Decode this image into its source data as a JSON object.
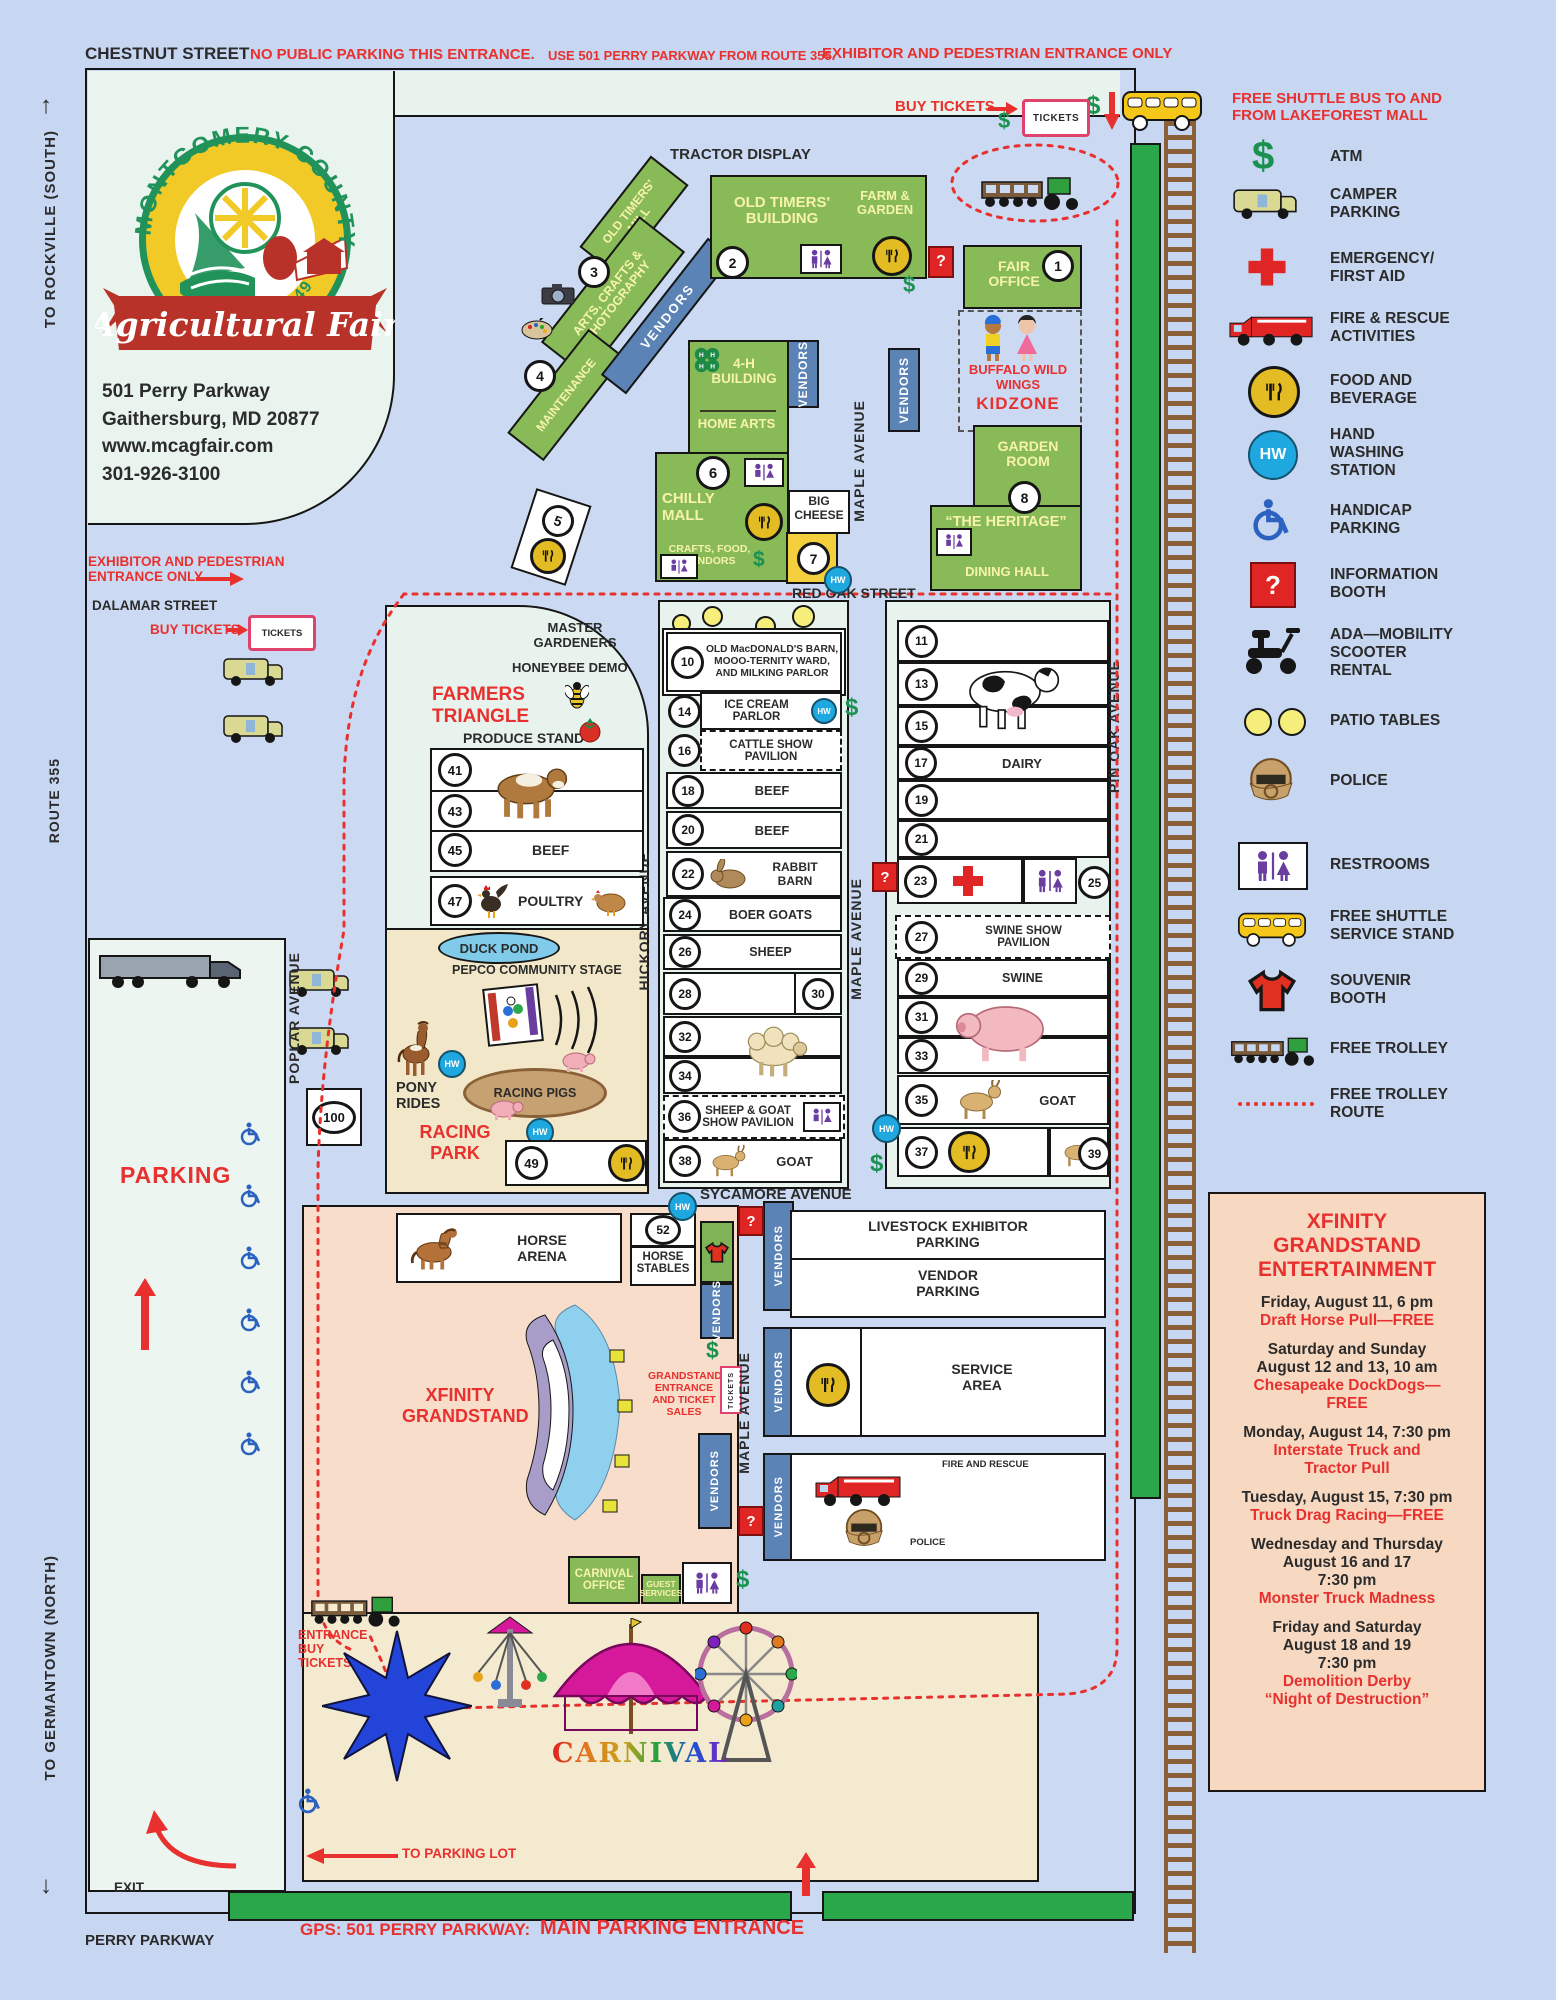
{
  "header": {
    "street": "CHESTNUT STREET",
    "warning_a": "NO PUBLIC PARKING THIS ENTRANCE.",
    "warning_b": "USE 501 PERRY PARKWAY FROM ROUTE 355.",
    "warning_c": "EXHIBITOR AND PEDESTRIAN ENTRANCE ONLY"
  },
  "side": {
    "rockville": "TO ROCKVILLE  (SOUTH)",
    "route355": "ROUTE 355",
    "germantown": "TO GERMANTOWN  (NORTH)"
  },
  "logo": {
    "arc": "MONTGOMERY COUNTY",
    "script": "Agricultural Fair",
    "founded": "FOUNDED 1949",
    "addr1": "501 Perry Parkway",
    "addr2": "Gaithersburg, MD 20877",
    "addr3": "www.mcagfair.com",
    "addr4": "301-926-3100"
  },
  "top": {
    "buy_tickets": "BUY TICKETS",
    "tickets": "TICKETS",
    "tractor_display": "TRACTOR DISPLAY",
    "shuttle": "FREE SHUTTLE BUS TO AND\nFROM LAKEFOREST MALL"
  },
  "streets": {
    "red_oak": "RED OAK STREET",
    "sycamore": "SYCAMORE AVENUE",
    "maple": "MAPLE AVENUE",
    "hickory": "HICKORY AVENUE",
    "pin_oak": "PIN OAK AVENUE",
    "poplar": "POPLAR AVENUE",
    "dalamar": "DALAMAR STREET",
    "perry": "PERRY PARKWAY"
  },
  "entrances": {
    "exhibitor": "EXHIBITOR AND PEDESTRIAN\nENTRANCE ONLY",
    "buy_tickets": "BUY TICKETS",
    "tickets": "TICKETS",
    "to_parking": "TO PARKING LOT",
    "gps": "GPS: 501 PERRY PARKWAY:",
    "main": "MAIN PARKING ENTRANCE",
    "exit": "EXIT",
    "carnival_entrance": "ENTRANCE\nBUY\nTICKETS"
  },
  "buildings": {
    "old_timers_mill": "OLD TIMERS'\nMILL",
    "num3": "3",
    "arts_crafts": "ARTS, CRAFTS &\nPHOTOGRAPHY",
    "num4": "4",
    "maintenance": "MAINTENANCE",
    "vendors": "VENDORS",
    "old_timers": "OLD TIMERS'\nBUILDING",
    "num2": "2",
    "farm_garden": "FARM &\nGARDEN",
    "fair_office": "FAIR\nOFFICE",
    "num1": "1",
    "kidzone_sponsor": "BUFFALO WILD\nWINGS",
    "kidzone": "KIDZONE",
    "fourh": "4-H\nBUILDING",
    "home_arts": "HOME ARTS",
    "num6": "6",
    "chilly_mall": "CHILLY\nMALL",
    "crafts_food": "CRAFTS, FOOD,\nVENDORS",
    "big_cheese": "BIG\nCHEESE",
    "num7": "7",
    "num5": "5",
    "garden_room": "GARDEN\nROOM",
    "num8": "8",
    "heritage": "“THE HERITAGE”",
    "dining_hall": "DINING HALL"
  },
  "farmers": {
    "master_gardeners": "MASTER\nGARDENERS",
    "honeybee": "HONEYBEE DEMO",
    "title": "FARMERS\nTRIANGLE",
    "produce": "PRODUCE STAND",
    "rows": [
      {
        "num": "41",
        "label": ""
      },
      {
        "num": "43",
        "label": ""
      },
      {
        "num": "45",
        "label": "BEEF"
      }
    ],
    "poultry_num": "47",
    "poultry": "POULTRY"
  },
  "racing": {
    "duck_pond": "DUCK POND",
    "pepco": "PEPCO COMMUNITY STAGE",
    "pony": "PONY\nRIDES",
    "pigs": "RACING PIGS",
    "title": "RACING\nPARK",
    "num49": "49",
    "num100": "100"
  },
  "barns_mid": {
    "r10": {
      "num": "10",
      "label": "OLD MacDONALD'S BARN,\nMOOO-TERNITY WARD,\nAND MILKING PARLOR"
    },
    "r14": {
      "num": "14",
      "label": "ICE CREAM\nPARLOR"
    },
    "r16": {
      "num": "16",
      "label": "CATTLE SHOW\nPAVILION"
    },
    "r18": {
      "num": "18",
      "label": "BEEF"
    },
    "r20": {
      "num": "20",
      "label": "BEEF"
    },
    "r22": {
      "num": "22",
      "label": "RABBIT\nBARN"
    },
    "r24": {
      "num": "24",
      "label": "BOER GOATS"
    },
    "r26": {
      "num": "26",
      "label": "SHEEP"
    },
    "r28": "28",
    "r30": "30",
    "r32": "32",
    "r34": "34",
    "r36": {
      "num": "36",
      "label": "SHEEP & GOAT\nSHOW PAVILION"
    },
    "r38": {
      "num": "38",
      "label": "GOAT"
    }
  },
  "barns_right": {
    "r11": "11",
    "r13": "13",
    "r15": "15",
    "r17": {
      "num": "17",
      "label": "DAIRY"
    },
    "r19": "19",
    "r21": "21",
    "r23": "23",
    "r25": "25",
    "r27": {
      "num": "27",
      "label": "SWINE SHOW\nPAVILION"
    },
    "r29": {
      "num": "29",
      "label": "SWINE"
    },
    "r31": "31",
    "r33": "33",
    "r35": {
      "num": "35",
      "label": "GOAT"
    },
    "r37": "37",
    "r39": "39"
  },
  "south": {
    "horse_arena": "HORSE\nARENA",
    "num52": "52",
    "horse_stables": "HORSE\nSTABLES",
    "xfinity": "XFINITY\nGRANDSTAND",
    "grandstand_entrance": "GRANDSTAND\nENTRANCE\nAND TICKET SALES",
    "tickets": "TICKETS",
    "livestock": "LIVESTOCK EXHIBITOR\nPARKING",
    "vendor_parking": "VENDOR\nPARKING",
    "service": "SERVICE\nAREA",
    "fire": "FIRE AND RESCUE",
    "police": "POLICE",
    "carnival_office": "CARNIVAL\nOFFICE",
    "guest": "GUEST\nSERVICES",
    "carnival": "CARNIVAL",
    "parking": "PARKING"
  },
  "legend": {
    "items": [
      {
        "icon": "atm-icon",
        "label": "ATM"
      },
      {
        "icon": "camper-icon",
        "label": "CAMPER\nPARKING"
      },
      {
        "icon": "first-aid-icon",
        "label": "EMERGENCY/\nFIRST AID"
      },
      {
        "icon": "fire-truck-icon",
        "label": "FIRE & RESCUE\nACTIVITIES"
      },
      {
        "icon": "food-icon",
        "label": "FOOD AND\nBEVERAGE"
      },
      {
        "icon": "hand-wash-icon",
        "label": "HAND\nWASHING\nSTATION"
      },
      {
        "icon": "handicap-icon",
        "label": "HANDICAP\nPARKING"
      },
      {
        "icon": "information-icon",
        "label": "INFORMATION\nBOOTH"
      },
      {
        "icon": "scooter-icon",
        "label": "ADA—MOBILITY\nSCOOTER\nRENTAL"
      },
      {
        "icon": "patio-icon",
        "label": "PATIO TABLES"
      },
      {
        "icon": "police-icon",
        "label": "POLICE"
      },
      {
        "icon": "restroom-icon",
        "label": "RESTROOMS"
      },
      {
        "icon": "shuttle-icon",
        "label": "FREE SHUTTLE\nSERVICE STAND"
      },
      {
        "icon": "souvenir-icon",
        "label": "SOUVENIR\nBOOTH"
      },
      {
        "icon": "trolley-icon",
        "label": "FREE TROLLEY"
      },
      {
        "icon": "trolley-route-icon",
        "label": "FREE TROLLEY\nROUTE"
      }
    ]
  },
  "entertainment": {
    "title": "XFINITY\nGRANDSTAND\nENTERTAINMENT",
    "events": [
      {
        "when": "Friday, August 11, 6 pm",
        "what": "Draft Horse Pull—FREE"
      },
      {
        "when": "Saturday and Sunday\nAugust 12 and 13,  10 am",
        "what": "Chesapeake DockDogs—\nFREE"
      },
      {
        "when": "Monday, August 14, 7:30 pm",
        "what": "Interstate Truck and\nTractor Pull"
      },
      {
        "when": "Tuesday, August 15, 7:30 pm",
        "what": "Truck Drag Racing—FREE"
      },
      {
        "when": "Wednesday and Thursday\nAugust 16 and 17\n7:30  pm",
        "what": "Monster Truck Madness"
      },
      {
        "when": "Friday and Saturday\nAugust 18 and 19\n7:30  pm",
        "what": "Demolition Derby\n“Night of Destruction”"
      }
    ]
  },
  "badges": {
    "hw": "HW",
    "dollar": "$",
    "question": "?"
  }
}
